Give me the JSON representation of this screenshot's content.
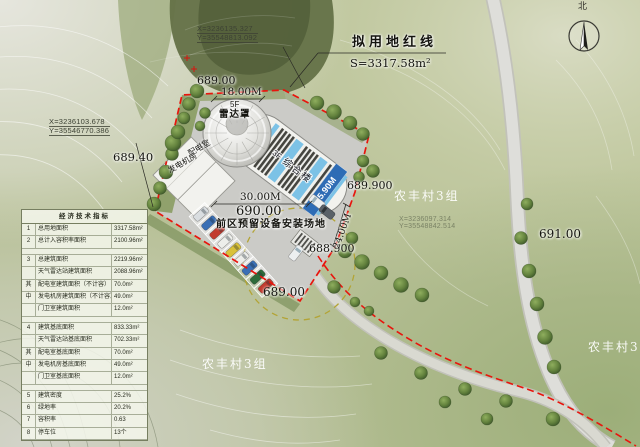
{
  "indicator_table": {
    "title": "经济技术指标",
    "rows": [
      {
        "no": "1",
        "label": "总用地面积",
        "value": "3317.58m²"
      },
      {
        "no": "2",
        "label": "总计入容积率面积",
        "value": "2100.96m²"
      },
      {
        "blank": true
      },
      {
        "no": "3",
        "label": "总建筑面积",
        "value": "2219.96m²"
      },
      {
        "no": "",
        "label": "天气雷达站建筑面积",
        "value": "2088.96m²"
      },
      {
        "no": "其",
        "label": "配电室建筑面积（不计容）",
        "value": "70.0m²"
      },
      {
        "no": "中",
        "label": "发电机房建筑面积（不计容）",
        "value": "49.0m²"
      },
      {
        "no": "",
        "label": "门卫室建筑面积",
        "value": "12.0m²"
      },
      {
        "blank": true
      },
      {
        "no": "4",
        "label": "建筑基底面积",
        "value": "833.33m²"
      },
      {
        "no": "",
        "label": "天气雷达站基底面积",
        "value": "702.33m²"
      },
      {
        "no": "其",
        "label": "配电室基底面积",
        "value": "70.0m²"
      },
      {
        "no": "中",
        "label": "发电机房基底面积",
        "value": "49.0m²"
      },
      {
        "no": "",
        "label": "门卫室基底面积",
        "value": "12.0m²"
      },
      {
        "blank": true
      },
      {
        "no": "5",
        "label": "建筑密度",
        "value": "25.2%"
      },
      {
        "no": "6",
        "label": "绿地率",
        "value": "20.2%"
      },
      {
        "no": "7",
        "label": "容积率",
        "value": "0.63"
      },
      {
        "no": "8",
        "label": "停车位",
        "value": "13个"
      }
    ]
  },
  "annotations": {
    "coord_top": {
      "x": "X=3236135.327",
      "y": "Y=35548813.092"
    },
    "coord_left": {
      "x": "X=3236103.678",
      "y": "Y=35546770.386"
    },
    "coord_right": {
      "x": "X=3236097.314",
      "y": "Y=35548842.514"
    },
    "redline": {
      "title": "拟用地红线",
      "area": "S=3317.58m²"
    },
    "elevations": {
      "e_top": "689.00",
      "e_west": "689.40",
      "e_plaza": "690.00",
      "e_gate": "688.900",
      "e_east": "689.900",
      "e_south": "689.00",
      "e_hill": "691.00"
    },
    "dims": {
      "d30": "30.00M",
      "d18": "18.00M",
      "d24": "24.00M",
      "d1590": "15.90M"
    },
    "buildings": {
      "dome_floor": "5F",
      "dome": "雷达罩",
      "complex_floor": "3F",
      "complex": "综合楼",
      "power_floor": "1F",
      "power": "配电室",
      "generator": "发电机房"
    },
    "site_note": "前区预留设备安装场地",
    "villages": {
      "v_east": "农丰村3组",
      "v_south": "农丰村3组",
      "v_corner": "农丰村3组"
    },
    "compass_north": "北"
  },
  "map": {
    "trees": [
      [
        154,
        204,
        7
      ],
      [
        160,
        188,
        6.5
      ],
      [
        166,
        172,
        7
      ],
      [
        172,
        154,
        6.5
      ],
      [
        173,
        143,
        8
      ],
      [
        178,
        132,
        7
      ],
      [
        184,
        118,
        6
      ],
      [
        189,
        104,
        6.5
      ],
      [
        197,
        91,
        7
      ],
      [
        205,
        113,
        5.5
      ],
      [
        200,
        126,
        5
      ],
      [
        317,
        103,
        7
      ],
      [
        334,
        112,
        7.5
      ],
      [
        350,
        123,
        7
      ],
      [
        363,
        134,
        6.5
      ],
      [
        363,
        161,
        6
      ],
      [
        373,
        171,
        6.5
      ],
      [
        359,
        177,
        5.5
      ],
      [
        352,
        238,
        6
      ],
      [
        345,
        251,
        7
      ],
      [
        362,
        262,
        7.5
      ],
      [
        381,
        273,
        7
      ],
      [
        401,
        285,
        7.5
      ],
      [
        422,
        295,
        7
      ],
      [
        334,
        287,
        6.5
      ],
      [
        355,
        302,
        5
      ],
      [
        369,
        311,
        5
      ],
      [
        527,
        204,
        6
      ],
      [
        521,
        238,
        6.5
      ],
      [
        529,
        271,
        7
      ],
      [
        537,
        304,
        7
      ],
      [
        545,
        337,
        7.5
      ],
      [
        554,
        367,
        7
      ],
      [
        381,
        353,
        6.5
      ],
      [
        421,
        373,
        6.5
      ],
      [
        465,
        389,
        6.5
      ],
      [
        506,
        401,
        6.5
      ],
      [
        553,
        419,
        7
      ],
      [
        487,
        419,
        6
      ],
      [
        445,
        402,
        6
      ]
    ],
    "parking": {
      "start_x": 201,
      "start_y": 214,
      "step_x": 8.1,
      "step_y": 9,
      "angle": 48,
      "car_colors": [
        "#d9dde0",
        "#3a6fb5",
        "#c23b2e",
        "#edeeea",
        "#d9c13a",
        "#edeeea",
        "#3a6fb5",
        "#2e6b3a",
        "#c23b2e"
      ]
    },
    "colors": {
      "red_line": "#e8150d",
      "equipment_circle": "#b3a435",
      "skylight": "#7cc2e6",
      "dimension_tag": "#2e6cb5"
    }
  }
}
